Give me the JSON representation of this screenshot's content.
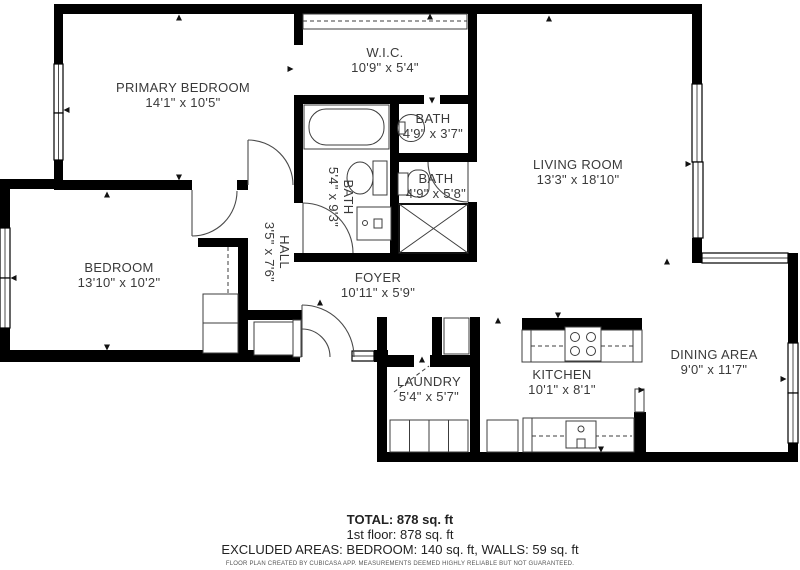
{
  "rooms": {
    "primary_bedroom": {
      "name": "PRIMARY BEDROOM",
      "dims": "14'1\" x 10'5\""
    },
    "wic": {
      "name": "W.I.C.",
      "dims": "10'9\" x 5'4\""
    },
    "bath_top": {
      "name": "BATH",
      "dims": "4'9\" x 3'7\""
    },
    "bath_mid": {
      "name": "BATH",
      "dims": "4'9\" x 5'8\""
    },
    "bath_main": {
      "name": "BATH",
      "dims": "5'4\" x 9'3\""
    },
    "hall": {
      "name": "HALL",
      "dims": "3'5\" x 7'6\""
    },
    "living_room": {
      "name": "LIVING ROOM",
      "dims": "13'3\" x 18'10\""
    },
    "bedroom": {
      "name": "BEDROOM",
      "dims": "13'10\" x 10'2\""
    },
    "foyer": {
      "name": "FOYER",
      "dims": "10'11\" x 5'9\""
    },
    "dining_area": {
      "name": "DINING AREA",
      "dims": "9'0\" x 11'7\""
    },
    "kitchen": {
      "name": "KITCHEN",
      "dims": "10'1\" x 8'1\""
    },
    "laundry": {
      "name": "LAUNDRY",
      "dims": "5'4\" x 5'7\""
    }
  },
  "summary": {
    "total": "TOTAL: 878 sq. ft",
    "floor1": "1st floor: 878 sq. ft",
    "excluded": "EXCLUDED AREAS: BEDROOM: 140 sq. ft, WALLS: 59 sq. ft",
    "disclaimer": "FLOOR PLAN CREATED BY CUBICASA APP. MEASUREMENTS DEEMED HIGHLY RELIABLE BUT NOT GUARANTEED."
  },
  "colors": {
    "wall": "#000000",
    "text": "#3a3a3a",
    "background": "#ffffff"
  }
}
